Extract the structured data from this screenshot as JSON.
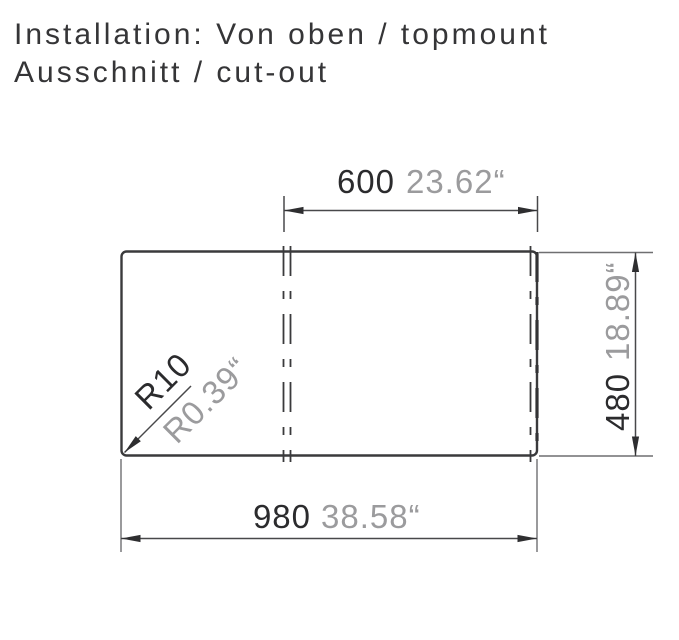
{
  "title": {
    "line1": "Installation: Von oben / topmount",
    "line2": "Ausschnitt / cut-out"
  },
  "diagram": {
    "type": "technical-drawing-cutout-topview",
    "dims": {
      "top": {
        "mm": "600",
        "inch": "23.62“"
      },
      "right": {
        "mm": "480",
        "inch": "18.89“"
      },
      "bottom": {
        "mm": "980",
        "inch": "38.58“"
      },
      "radius": {
        "mm": "R10",
        "inch": "R0.39“"
      }
    },
    "colors": {
      "outline": "#3a3a3c",
      "dim_line": "#48484a",
      "ext_line": "#6f6f71",
      "text_primary": "#2b2b2d",
      "text_secondary": "#9b9b9d",
      "title_text": "#353537",
      "background": "#ffffff"
    }
  }
}
